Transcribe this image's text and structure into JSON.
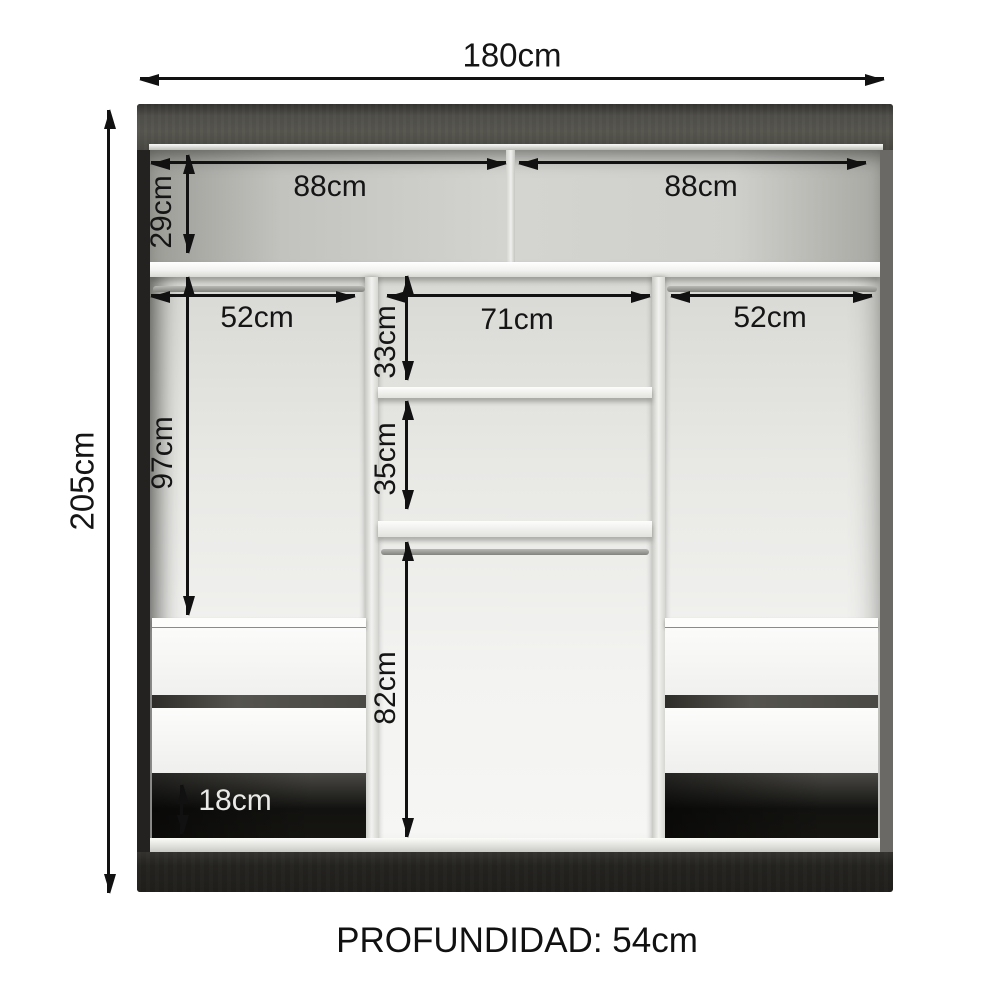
{
  "diagram": {
    "depth_label": "PROFUNDIDAD: 54cm",
    "dims": {
      "total_width": "180cm",
      "total_height": "205cm",
      "top_left_width": "88cm",
      "top_right_width": "88cm",
      "top_section_height": "29cm",
      "left_column_width": "52cm",
      "center_column_width": "71cm",
      "right_column_width": "52cm",
      "center_upper_height": "33cm",
      "center_middle_height": "35cm",
      "left_hanging_height": "97cm",
      "center_hanging_height": "82cm",
      "base_gap_height": "18cm"
    },
    "colors": {
      "frame_dark": "#3a3935",
      "plinth": "#242320",
      "interior_light": "#f3f3f1",
      "shelf_white": "#fdfdfc",
      "dimension_text": "#151515"
    }
  }
}
